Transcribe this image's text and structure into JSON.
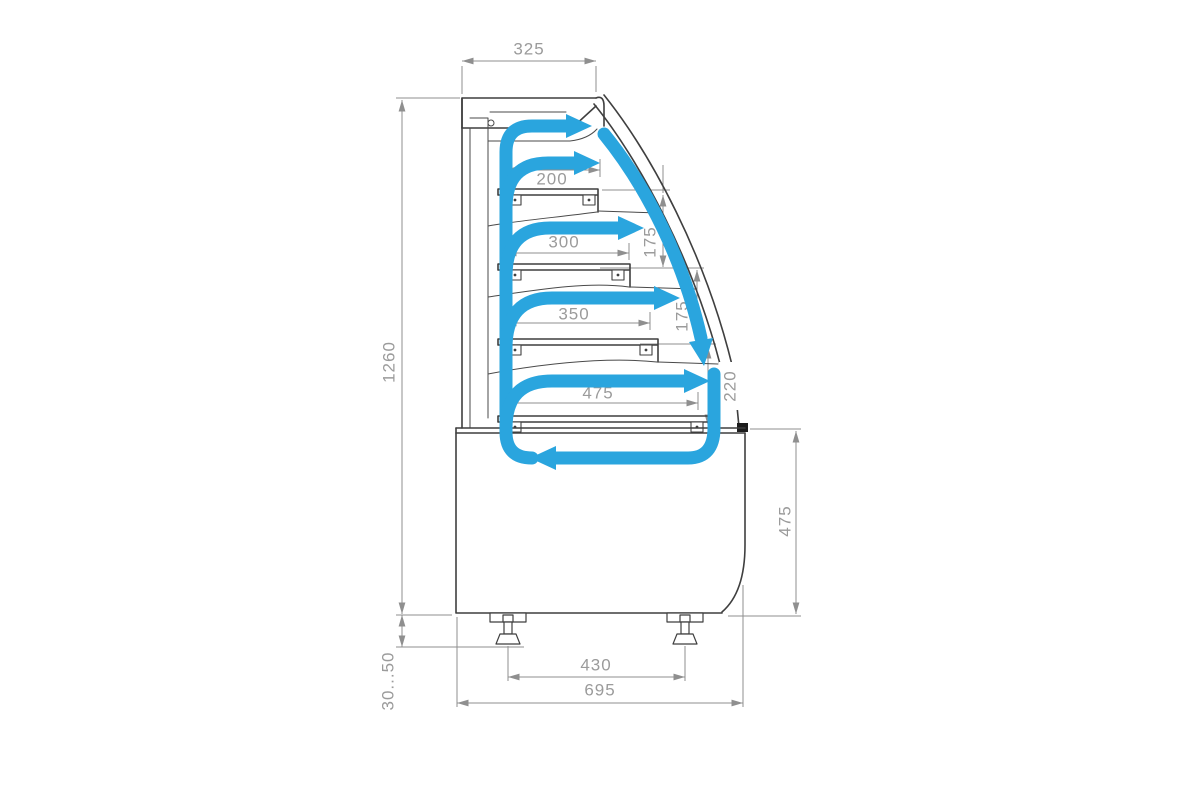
{
  "page": {
    "description": "Side cross-section technical drawing of a curved-glass refrigerated pastry display case with blue air-circulation arrows and dimensions in millimetres"
  },
  "colors": {
    "airflow": "#2AA5DE",
    "outline": "#3f3f3f",
    "dimension_line": "#8f8f8f",
    "dimension_text": "#9b9b9b",
    "glass_end_cap": "#1c1c1c",
    "background": "#ffffff"
  },
  "dimensions": {
    "canopy_depth": "325",
    "overall_height": "1260",
    "shelf1_depth": "200",
    "shelf2_depth": "300",
    "shelf3_depth": "350",
    "deck_depth": "475",
    "shelf_gap_upper": "175",
    "shelf_gap_lower": "175",
    "deck_front_height": "220",
    "base_height": "475",
    "feet_spacing": "430",
    "overall_depth": "695",
    "foot_height_range": "30...50"
  },
  "airflow": {
    "arrow_count": 7,
    "arrows": [
      "top-outlet",
      "shelf-1",
      "shelf-2",
      "shelf-3",
      "deck",
      "glass-downdraft",
      "bottom-return"
    ]
  }
}
